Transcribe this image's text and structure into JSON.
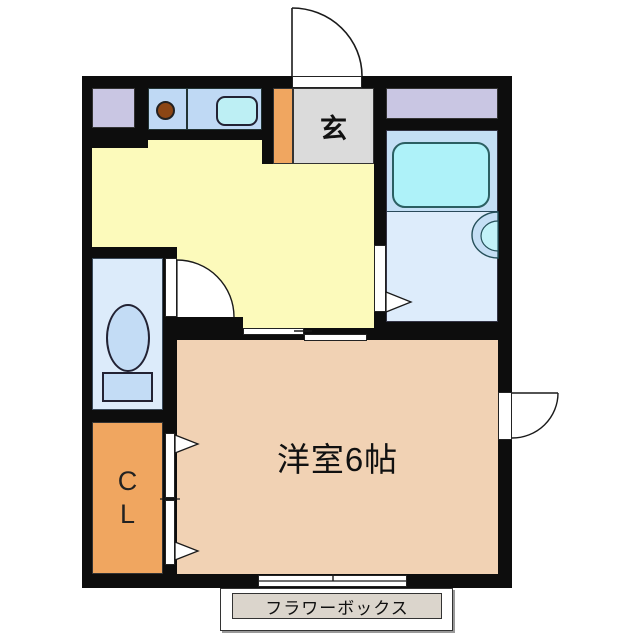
{
  "floorplan": {
    "type": "japanese-apartment-floorplan",
    "labels": {
      "genkan": "玄",
      "closet_line1": "C",
      "closet_line2": "L",
      "bedroom": "洋室6帖",
      "flower_box": "フラワーボックス"
    },
    "rooms": [
      {
        "name": "entrance-genkan",
        "label": "玄"
      },
      {
        "name": "dining-kitchen",
        "label": ""
      },
      {
        "name": "bathroom-with-tub",
        "label": ""
      },
      {
        "name": "washroom",
        "label": ""
      },
      {
        "name": "toilet-room",
        "label": ""
      },
      {
        "name": "closet",
        "label": "CL"
      },
      {
        "name": "western-room-6-tatami",
        "label": "洋室6帖"
      },
      {
        "name": "flower-box",
        "label": "フラワーボックス"
      }
    ],
    "colors": {
      "wall": "#0d0d0d",
      "dk_floor_yellow": "#FCFABB",
      "bedroom_floor_pink": "#F1D2B4",
      "genkan_gray": "#DBDBDB",
      "step_orange": "#F0A660",
      "closet_orange": "#F0A660",
      "counter_blue": "#BFD9F4",
      "sink_cyan": "#BDEFF4",
      "bathtub_cyan": "#AEF2F9",
      "bath_zone_blue": "#C4DFF5",
      "washroom_blue": "#DDECFB",
      "toilet_room_blue": "#DCEBFA",
      "fixture_blue": "#C3DCF5",
      "appliance_lavender": "#C9C6E3",
      "burner_brown": "#8C4614",
      "flower_box_beige": "#DBD5CC"
    }
  }
}
